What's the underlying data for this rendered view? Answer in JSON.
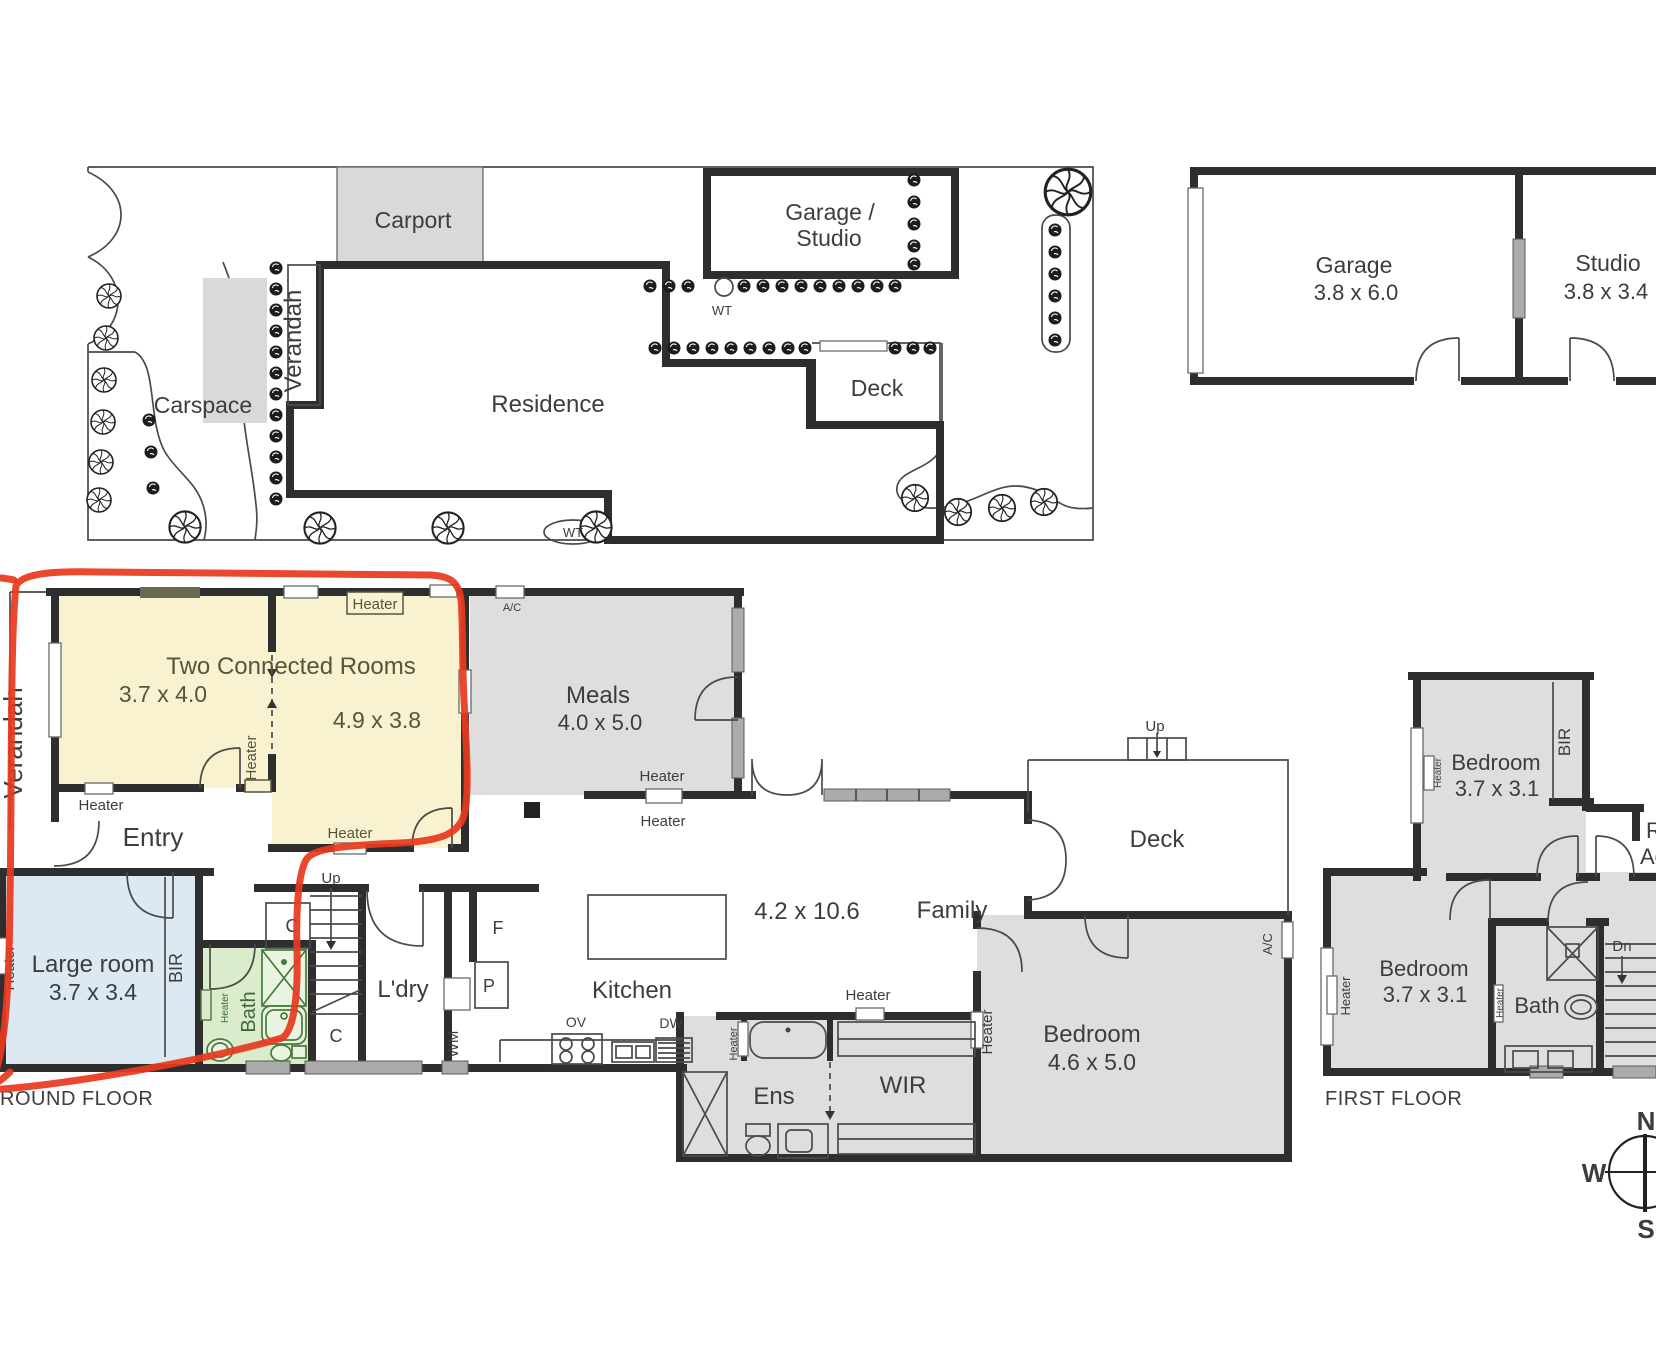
{
  "shared": {
    "heater": "Heater",
    "wt": "WT",
    "cupboard": "C",
    "up": "Up"
  },
  "site_plan": {
    "carport": "Carport",
    "carspace": "Carspace",
    "verandah": "Verandah",
    "residence": "Residence",
    "garage_studio": [
      "Garage /",
      "Studio"
    ],
    "deck": "Deck"
  },
  "outbuildings": {
    "garage_name": "Garage",
    "garage_dims": "3.8 x 6.0",
    "studio_name": "Studio",
    "studio_dims": "3.8 x 3.4"
  },
  "ground_floor": {
    "floor_label": "GROUND FLOOR",
    "verandah": "Verandah",
    "highlight_title": "Two Connected Rooms",
    "room_a_dims": "3.7 x 4.0",
    "room_b_dims": "4.9 x 3.8",
    "entry": "Entry",
    "meals_name": "Meals",
    "meals_dims": "4.0 x 5.0",
    "ac": "A/C",
    "large_room_name": "Large room",
    "large_room_dims": "3.7 x 3.4",
    "bir": "BIR",
    "bath": "Bath",
    "laundry": "L'dry",
    "wm": "WM",
    "fridge": "F",
    "pantry": "P",
    "kitchen": "Kitchen",
    "oven": "OV",
    "dishwasher": "DW",
    "family_dims": "4.2 x 10.6",
    "family_name": "Family",
    "deck": "Deck",
    "ens": "Ens",
    "wir": "WIR",
    "bedroom_name": "Bedroom",
    "bedroom_dims": "4.6 x 5.0"
  },
  "first_floor": {
    "floor_label": "FIRST FLOOR",
    "bedroom_label": "Bedroom",
    "bedroom_dims": "3.7 x 3.1",
    "bir": "BIR",
    "bath": "Bath",
    "dn": "Dn",
    "roof_access_fragment_1": "R",
    "roof_access_fragment_2": "Ac"
  },
  "compass": {
    "north": "N",
    "west": "W",
    "south": "S"
  },
  "annotation": {
    "highlight_color": "#e8391f"
  },
  "colors": {
    "highlight_yellow": "#f8f2d0",
    "room_gray": "#dedede",
    "room_blue": "#dce9f2",
    "room_green": "#daeccb",
    "wall": "#2e2e2e",
    "window_gray": "#ababab"
  }
}
